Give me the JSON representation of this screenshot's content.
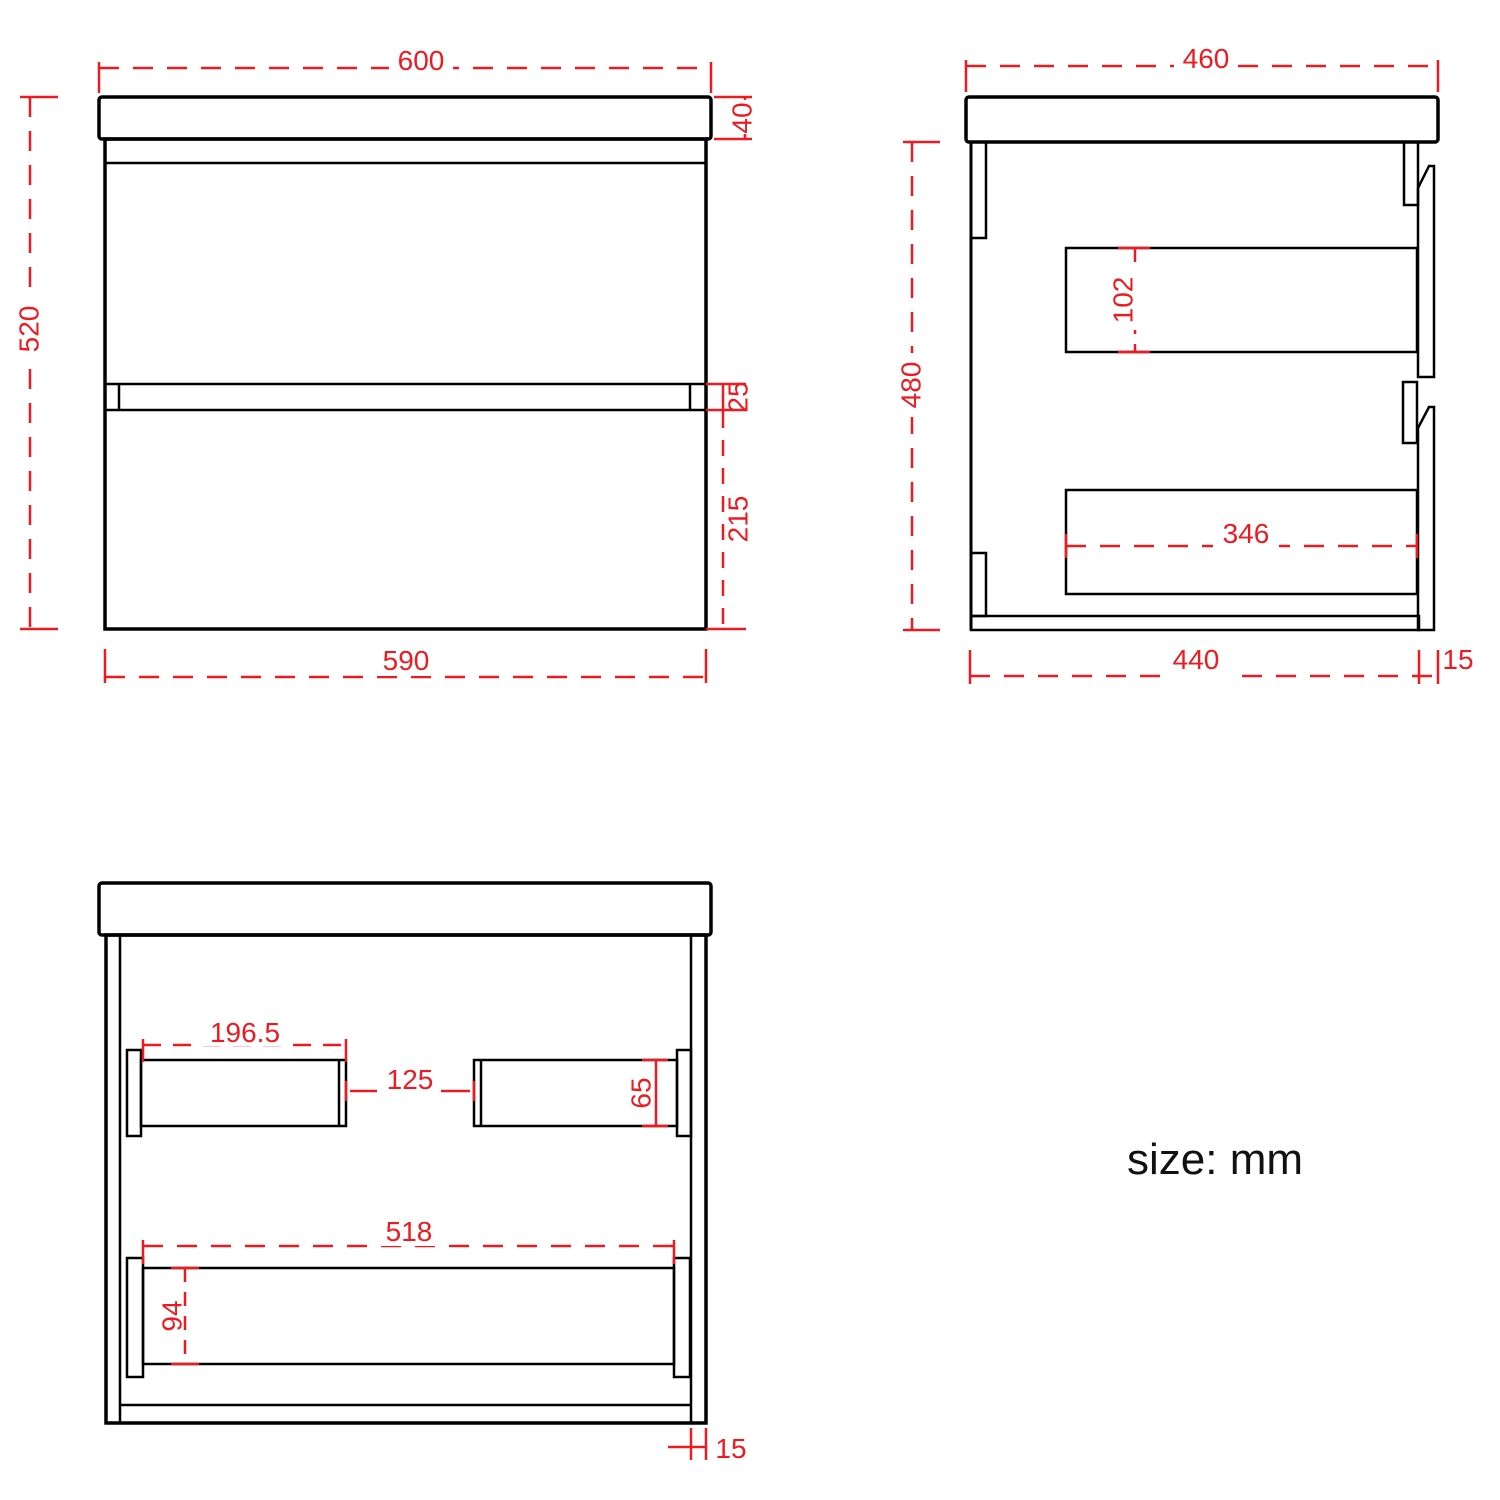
{
  "note": {
    "units": "size: mm"
  },
  "colors": {
    "line": "#000000",
    "dimension": "#ec1b21",
    "background": "#ffffff"
  },
  "views": {
    "front": {
      "title": "front-view",
      "dims": {
        "width_top": "600",
        "countertop_height": "40",
        "height_total": "520",
        "gap_between_drawers": "25",
        "lower_drawer_height": "215",
        "width_body": "590"
      }
    },
    "side": {
      "title": "side-view",
      "dims": {
        "depth_top": "460",
        "body_height": "480",
        "drawer_box_height": "102",
        "drawer_box_depth": "346",
        "body_depth": "440",
        "panel_thickness": "15"
      }
    },
    "internal": {
      "title": "internal-front-view",
      "dims": {
        "left_rail_length": "196.5",
        "rail_gap": "125",
        "rail_height": "65",
        "shelf_length": "518",
        "shelf_height": "94",
        "wall_thickness": "15"
      }
    }
  }
}
